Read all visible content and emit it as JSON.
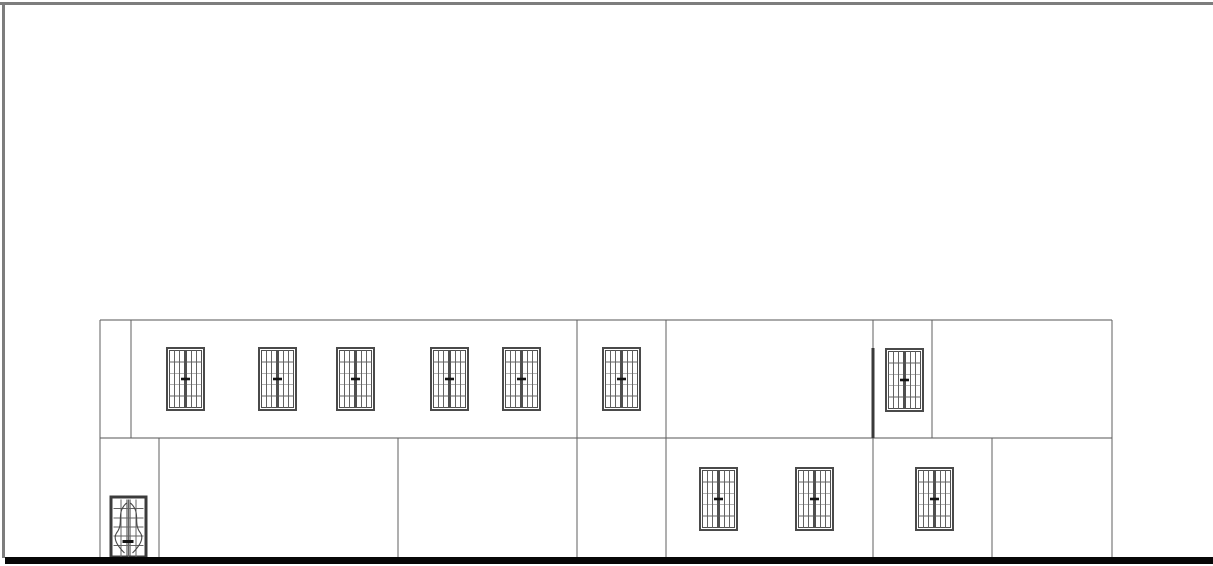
{
  "drawing": {
    "kind": "building-elevation",
    "canvas": {
      "width": 1213,
      "height": 566,
      "background": "#ffffff"
    }
  },
  "page_border": {
    "color": "#7d7d7d",
    "thickness": 3,
    "top_y": 2,
    "left_x": 2,
    "left_y1": 2,
    "left_y2": 558
  },
  "palette": {
    "wall_line": "#5f5f5f",
    "floor_line": "#565656",
    "window_frame": "#4a4a4a",
    "sash_frame": "#4f4f4f",
    "muntin": "#636363",
    "handle": "#141414",
    "door_frame": "#3c3c3c",
    "door_curve": "#474747",
    "ground": "#070707",
    "pier": "#3a3a3a"
  },
  "elevation": {
    "left_x": 100,
    "right_x": 1112,
    "upper_floor": {
      "top_y": 320,
      "bottom_y": 438,
      "divider_xs": [
        131,
        932
      ]
    },
    "lower_floor": {
      "top_y": 438,
      "bottom_y": 557,
      "divider_xs": [
        159,
        398,
        992
      ]
    },
    "full_height_xs": [
      100,
      577,
      666,
      873,
      1112
    ],
    "pier": {
      "x": 873,
      "y1": 348,
      "y2": 438,
      "width": 3
    }
  },
  "ground_line": {
    "x1": 5,
    "x2": 1213,
    "y": 557,
    "thickness": 7
  },
  "window_style": {
    "sash_columns": 3,
    "sash_rows": 5,
    "frame_width": 2.4,
    "sash_frame_width": 1.2,
    "muntin_width": 0.9,
    "handle_w": 9,
    "handle_h": 2.6
  },
  "upper_windows": [
    {
      "x": 167,
      "y": 348,
      "w": 37,
      "h": 62
    },
    {
      "x": 259,
      "y": 348,
      "w": 37,
      "h": 62
    },
    {
      "x": 337,
      "y": 348,
      "w": 37,
      "h": 62
    },
    {
      "x": 431,
      "y": 348,
      "w": 37,
      "h": 62
    },
    {
      "x": 503,
      "y": 348,
      "w": 37,
      "h": 62
    },
    {
      "x": 603,
      "y": 348,
      "w": 37,
      "h": 62
    },
    {
      "x": 886,
      "y": 349,
      "w": 37,
      "h": 62
    }
  ],
  "lower_windows": [
    {
      "x": 700,
      "y": 468,
      "w": 37,
      "h": 62
    },
    {
      "x": 796,
      "y": 468,
      "w": 37,
      "h": 62
    },
    {
      "x": 916,
      "y": 468,
      "w": 37,
      "h": 62
    }
  ],
  "door": {
    "x": 111,
    "y": 497,
    "w": 35,
    "h": 60,
    "columns": 4,
    "rows": 6
  }
}
